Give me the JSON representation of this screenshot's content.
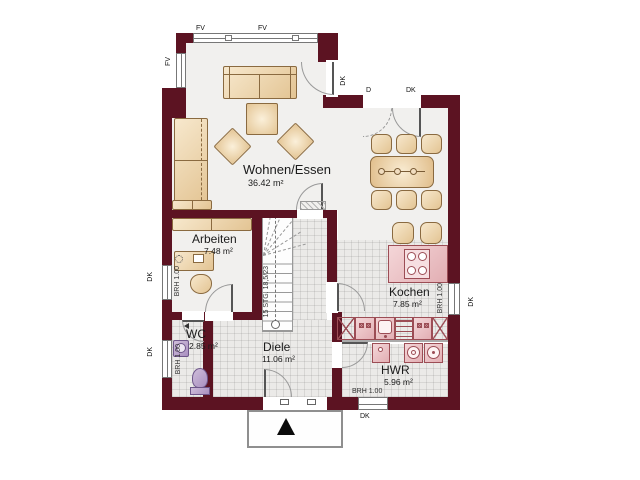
{
  "rooms": {
    "living": {
      "name": "Wohnen/Essen",
      "area": "36.42 m²"
    },
    "office": {
      "name": "Arbeiten",
      "area": "7.48 m²"
    },
    "kitchen": {
      "name": "Kochen",
      "area": "7.85 m²"
    },
    "wc": {
      "name": "WC",
      "area": "2.85 m²"
    },
    "hall": {
      "name": "Diele",
      "area": "11.06 m²"
    },
    "utility": {
      "name": "HWR",
      "area": "5.96 m²"
    }
  },
  "window_labels": {
    "fv": "FV",
    "dk": "DK",
    "d": "D",
    "brh": "BRH 1.00"
  },
  "stair": {
    "note": "15 STG. 18,5/23"
  },
  "colors": {
    "wall": "#5c1322",
    "kitchen_fixture": "#e2aeb3",
    "furniture": "#e3c493",
    "sanitary": "#a98fc0"
  }
}
